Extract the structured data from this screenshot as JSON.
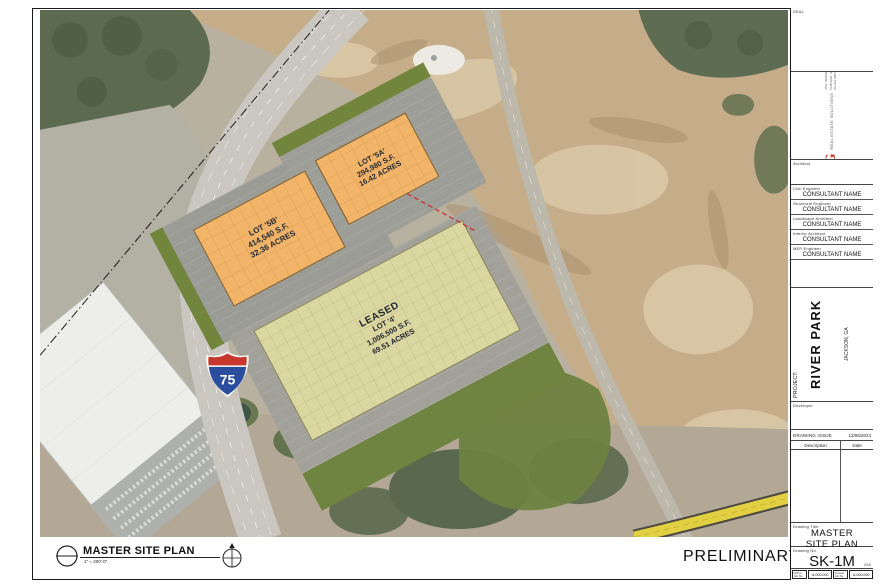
{
  "sheet": {
    "preliminary": "PRELIMINARY"
  },
  "view": {
    "title": "MASTER SITE PLAN",
    "scale": "1\" = 200'-0\""
  },
  "title_block": {
    "seal_label": "SEAL",
    "firm": {
      "name": "CRG",
      "tagline": "REAL ESTATE SOLUTIONS",
      "address_line1": "35 E. WACKER DRIVE",
      "address_line2": "CHICAGO, ILLINOIS 60601",
      "address_line3": "PH 312.658.0747  FX 314.429.1660"
    },
    "architect_label": "Architect",
    "consultants": [
      {
        "role": "Civil Engineer",
        "name": "CONSULTANT NAME"
      },
      {
        "role": "Structural Engineer",
        "name": "CONSULTANT NAME"
      },
      {
        "role": "Landscape Architect",
        "name": "CONSULTANT NAME"
      },
      {
        "role": "Interior Architect",
        "name": "CONSULTANT NAME"
      },
      {
        "role": "MEP Engineer",
        "name": "CONSULTANT NAME"
      }
    ],
    "project_label": "PROJECT:",
    "project_name": "RIVER PARK",
    "project_location": "JACKSON, GA",
    "developer_label": "Developer",
    "drawing_issue_label": "DRAWING ISSUE",
    "drawing_issue_date": "12/06/2024",
    "description_header": "Description",
    "date_header": "Date",
    "drawing_title_label": "Drawing Title",
    "drawing_title_line1": "MASTER",
    "drawing_title_line2": "SITE PLAN",
    "drawing_no_label": "Drawing No.",
    "drawing_no": "SK-1M",
    "footer": {
      "note": "XXX",
      "job1_label": "CRG's Job No.",
      "job1_no": "A-000-000",
      "job2_label": "Consult Job No.",
      "job2_no": "A-000-000"
    }
  },
  "map": {
    "lots": [
      {
        "id": "lot-5b",
        "lines": [
          "LOT '5B'",
          "414,540 S.F.",
          "32.36 ACRES"
        ]
      },
      {
        "id": "lot-5a",
        "lines": [
          "LOT '5A'",
          "294,980 S.F.",
          "16.42 ACRES"
        ]
      },
      {
        "id": "lot-4",
        "lines": [
          "LEASED",
          "LOT '4'",
          "1,006,500 S.F.",
          "69.51 ACRES"
        ]
      }
    ],
    "highway_shield": {
      "number": "75"
    }
  },
  "colors": {
    "crg_red": "#c23b2a",
    "building_orange": "#f1b469",
    "leased_tan": "#dbd7a0",
    "landscape_green": "#71863c",
    "highway_yellow": "#e3cf42",
    "shield_blue": "#2a4d9d",
    "shield_red": "#c8372d"
  }
}
